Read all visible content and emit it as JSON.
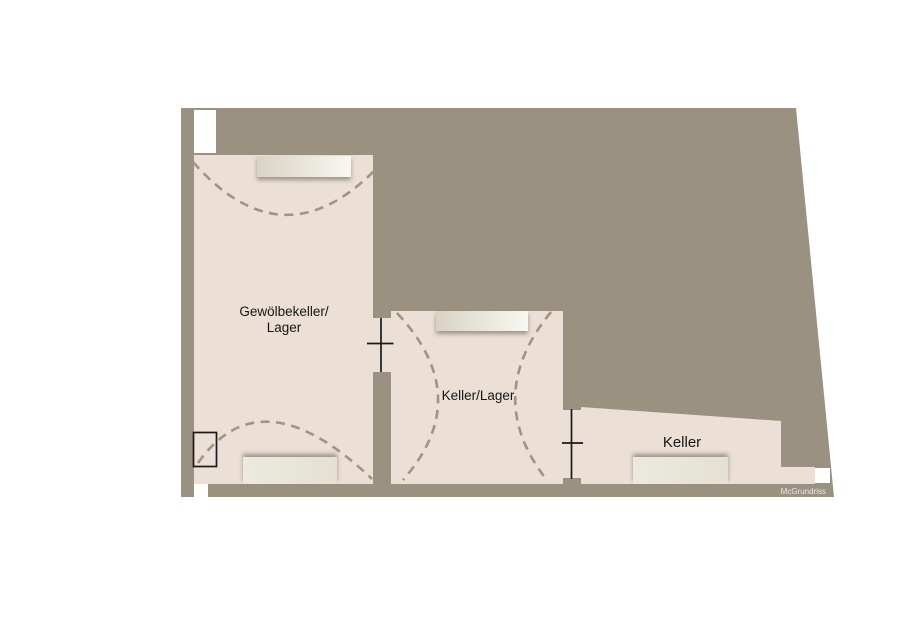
{
  "floorplan": {
    "rooms": [
      {
        "label_line1": "Gewölbekeller/",
        "label_line2": "Lager"
      },
      {
        "label": "Keller/Lager"
      },
      {
        "label": "Keller"
      }
    ],
    "watermark": "McGrundriss",
    "colors": {
      "background": "#ffffff",
      "wall_area": "#9b9180",
      "room_floor": "#ebdfd6",
      "vault_dash": "#a3947b",
      "door_line": "#1a1a1a",
      "label_text": "#161616",
      "niche_dark": "#d8d3c4",
      "niche_light": "#f8f7f1",
      "watermark_text": "#f2f1ee"
    }
  }
}
